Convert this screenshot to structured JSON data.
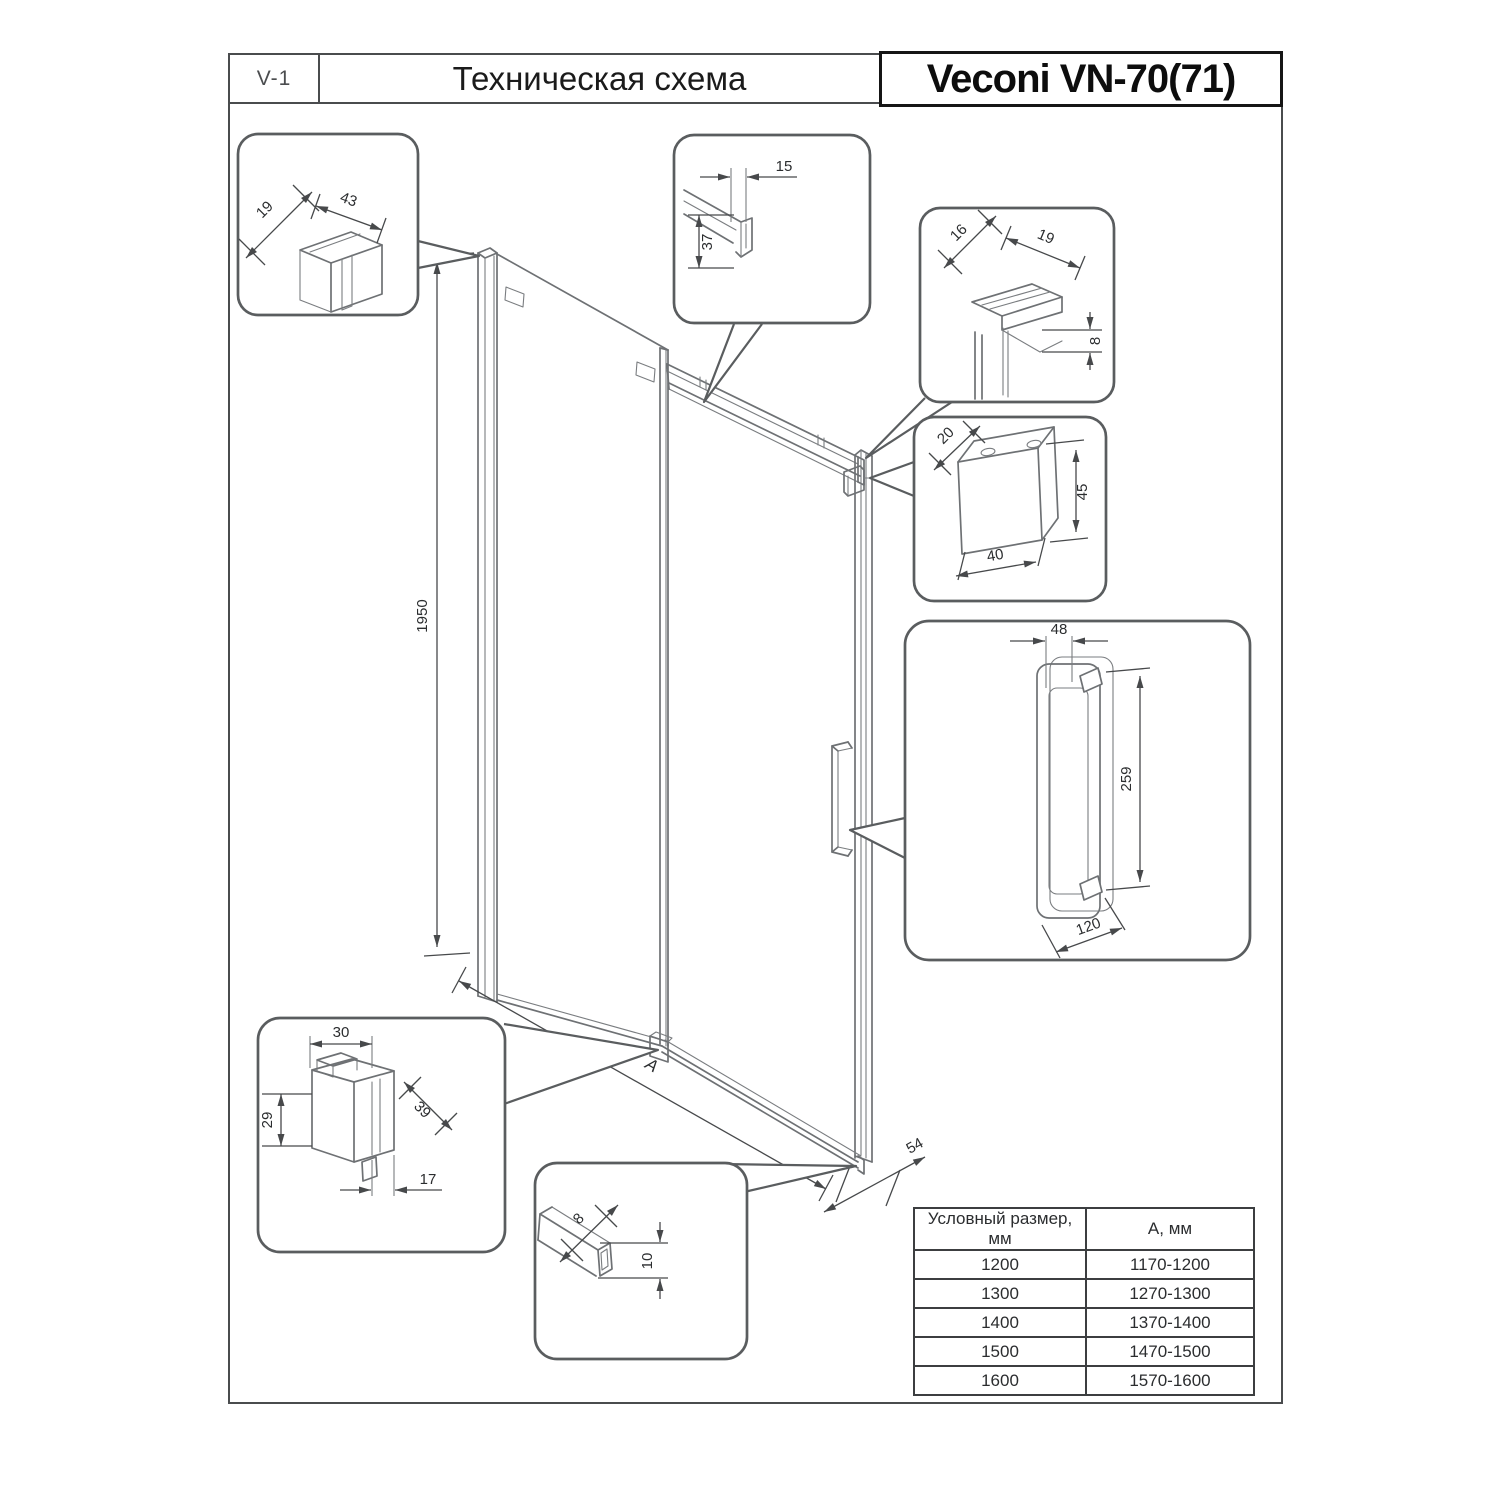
{
  "header": {
    "doc_code": "V-1",
    "title": "Техническая схема",
    "product": "Veconi VN-70(71)"
  },
  "drawing": {
    "overall": {
      "height": "1950",
      "width_label": "A",
      "bottom_rail_depth": "54"
    },
    "details": {
      "wall_profile": {
        "depth": "19",
        "width": "43"
      },
      "top_profile": {
        "width": "15",
        "height": "37"
      },
      "top_corner": {
        "depth": "16",
        "width": "19",
        "thickness": "8"
      },
      "wall_bracket": {
        "depth": "20",
        "height": "45",
        "width": "40"
      },
      "handle": {
        "top_width": "48",
        "length": "259",
        "base_width": "120"
      },
      "bottom_guide": {
        "width": "30",
        "height": "29",
        "depth": "39",
        "offset": "17"
      },
      "bottom_rail": {
        "width": "8",
        "height": "10"
      }
    }
  },
  "size_table": {
    "col_headers": [
      "Условный размер, мм",
      "А, мм"
    ],
    "rows": [
      [
        "1200",
        "1170-1200"
      ],
      [
        "1300",
        "1270-1300"
      ],
      [
        "1400",
        "1370-1400"
      ],
      [
        "1500",
        "1470-1500"
      ],
      [
        "1600",
        "1570-1600"
      ]
    ]
  },
  "colors": {
    "drawing_line": "#6e7174",
    "dimension_line": "#47494b",
    "text": "#2b2d2f"
  }
}
